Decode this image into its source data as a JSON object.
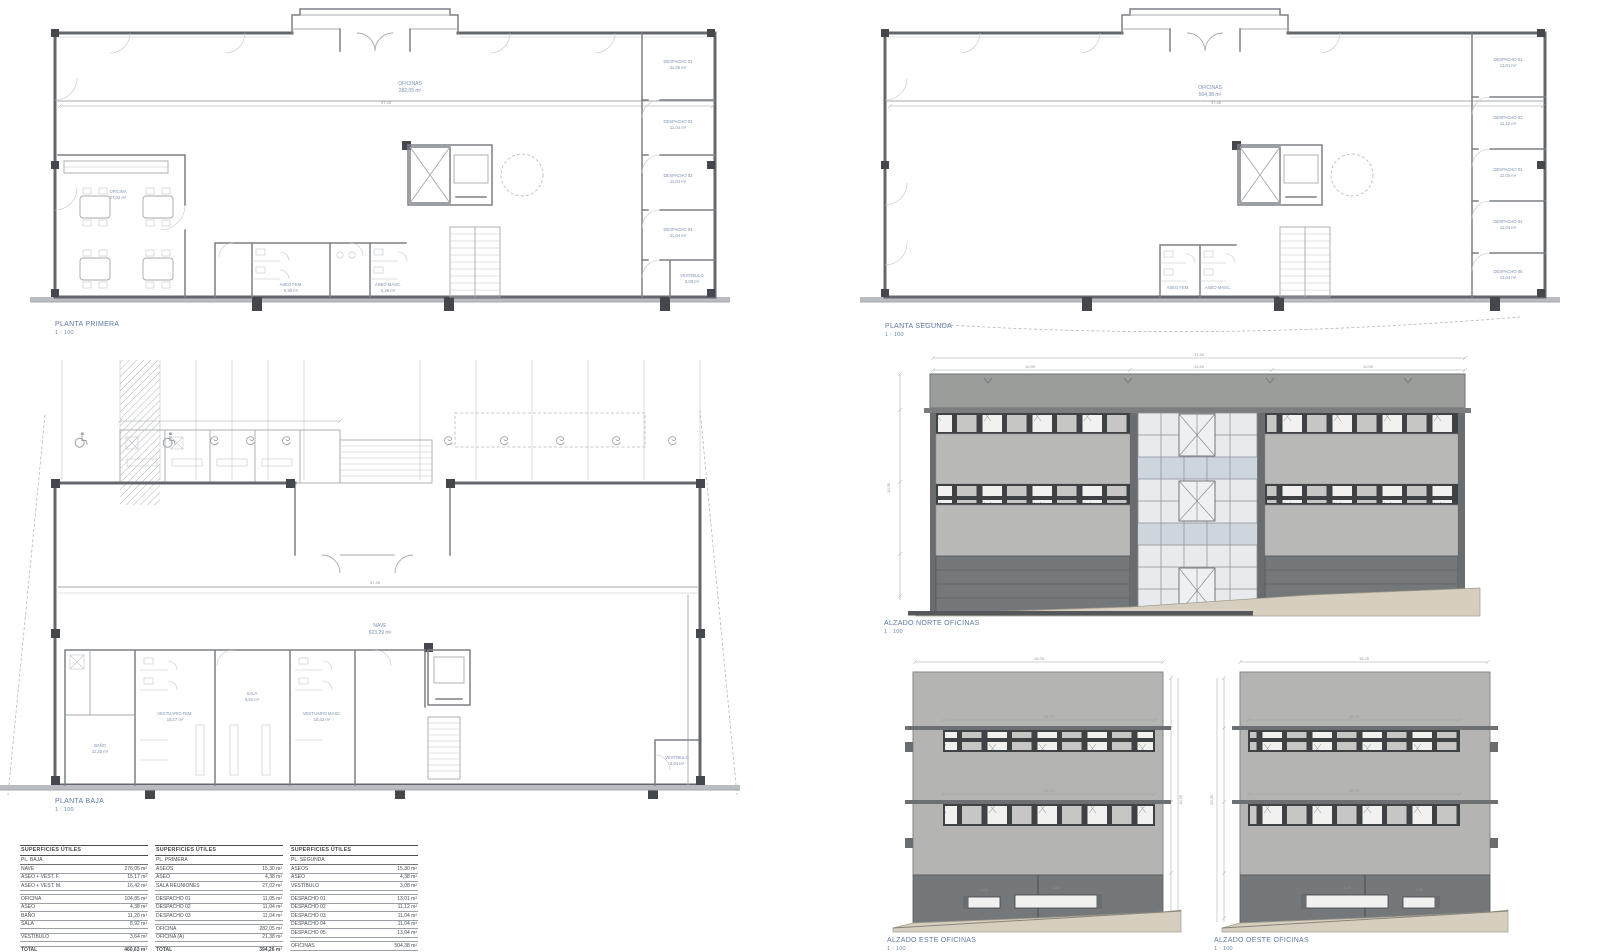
{
  "colors": {
    "label_blue": "#7b90b5",
    "title_blue": "#5d79a8",
    "wall_gray": "#63676c",
    "parapet_gray": "#9b9d9b",
    "spandrel_gray": "#b9bab7",
    "base_gray": "#75787b",
    "terrain_beige": "#d6cfc0",
    "glass_blue": "#ccd6dc"
  },
  "plans": {
    "first": {
      "title": "PLANTA PRIMERA",
      "scale": "1 : 100",
      "dim_overall": "37,45",
      "open_area": {
        "name": "OFICINAS",
        "area": "282,05 m²"
      },
      "meeting_room": {
        "name": "OFICINA",
        "area": "27,02 m²"
      },
      "toilets": [
        {
          "name": "ASEO FEM.",
          "area": "5,30 m²"
        },
        {
          "name": "ASEO MASC.",
          "area": "5,36 m²"
        }
      ],
      "vestibule": {
        "name": "VESTÍBULO",
        "area": "3,08 m²"
      },
      "offices": [
        {
          "name": "DESPACHO 01",
          "area": "11,05 m²"
        },
        {
          "name": "DESPACHO 02",
          "area": "11,04 m²"
        },
        {
          "name": "DESPACHO 03",
          "area": "11,04 m²"
        },
        {
          "name": "DESPACHO 04",
          "area": "11,04 m²"
        }
      ]
    },
    "second": {
      "title": "PLANTA SEGUNDA",
      "scale": "1 : 100",
      "dim_overall": "37,45",
      "open_area": {
        "name": "OFICINAS",
        "area": "504,38 m²"
      },
      "toilets": [
        {
          "name": "ASEO FEM.",
          "area": "5,30 m²"
        },
        {
          "name": "ASEO MASC.",
          "area": "5,36 m²"
        }
      ],
      "offices": [
        {
          "name": "DESPACHO 01",
          "area": "13,01 m²"
        },
        {
          "name": "DESPACHO 02",
          "area": "11,12 m²"
        },
        {
          "name": "DESPACHO 03",
          "area": "11,04 m²"
        },
        {
          "name": "DESPACHO 04",
          "area": "11,04 m²"
        },
        {
          "name": "DESPACHO 05",
          "area": "13,04 m²"
        }
      ]
    },
    "ground": {
      "title": "PLANTA BAJA",
      "scale": "1 : 100",
      "dim_overall": "37,45",
      "open_area": {
        "name": "NAVE",
        "area": "623,29 m²"
      },
      "rooms": [
        {
          "name": "BAÑO",
          "area": "11,20 m²"
        },
        {
          "name": "VESTUARIO FEM.",
          "area": "15,17 m²"
        },
        {
          "name": "SALA",
          "area": "8,92 m²"
        },
        {
          "name": "VESTUARIO MASC.",
          "area": "16,42 m²"
        },
        {
          "name": "VESTÍBULO",
          "area": "3,64 m²"
        }
      ]
    }
  },
  "elevations": {
    "north": {
      "title": "ALZADO NORTE OFICINAS",
      "scale": "1 : 100",
      "dims": {
        "overall": "37,45",
        "left_wing": "10,90",
        "center": "12,40",
        "right_wing": "10,90",
        "height": "10,35"
      }
    },
    "east": {
      "title": "ALZADO ESTE OFICINAS",
      "scale": "1 : 100",
      "dims": {
        "overall": "15,25",
        "strip_top": "12,70",
        "strip_mid": "12,70",
        "slot_small": "1,00",
        "slot_big": "4,20",
        "height": "10,35"
      }
    },
    "west": {
      "title": "ALZADO OESTE OFICINAS",
      "scale": "1 : 100",
      "dims": {
        "overall": "15,25",
        "strip_top": "12,70",
        "strip_mid": "12,70",
        "slot_small": "1,00",
        "slot_big": "4,20",
        "height": "10,35"
      }
    }
  },
  "tables": [
    {
      "header": "SUPERFICIES ÚTILES",
      "subheader": "PL. BAJA",
      "rows": [
        {
          "label": "NAVE",
          "value": "276,05 m²"
        },
        {
          "label": "ASEO + VEST. F.",
          "value": "15,17 m²"
        },
        {
          "label": "ASEO + VEST. M.",
          "value": "16,42 m²"
        },
        {
          "label": "OFICINA",
          "value": "104,85 m²",
          "gap": true
        },
        {
          "label": "ASEO",
          "value": "4,38 m²"
        },
        {
          "label": "BAÑO",
          "value": "11,20 m²"
        },
        {
          "label": "SALA",
          "value": "8,92 m²"
        },
        {
          "label": "VESTÍBULO",
          "value": "3,64 m²",
          "gap": true
        },
        {
          "label": "TOTAL",
          "value": "460,63 m²",
          "gap": true,
          "strong": true
        },
        {
          "label": "TOTAL CONST.",
          "value": "486,20 m²"
        }
      ]
    },
    {
      "header": "SUPERFICIES ÚTILES",
      "subheader": "PL. PRIMERA",
      "rows": [
        {
          "label": "ASEOS",
          "value": "15,30 m²"
        },
        {
          "label": "ASEO",
          "value": "4,38 m²"
        },
        {
          "label": "SALA REUNIONES",
          "value": "27,02 m²"
        },
        {
          "label": "DESPACHO 01",
          "value": "11,05 m²",
          "gap": true
        },
        {
          "label": "DESPACHO 02",
          "value": "11,04 m²"
        },
        {
          "label": "DESPACHO 03",
          "value": "11,04 m²"
        },
        {
          "label": "OFICINA",
          "value": "282,05 m²",
          "gap": true
        },
        {
          "label": "OFICINA (A)",
          "value": "21,38 m²"
        },
        {
          "label": "TOTAL",
          "value": "394,26 m²",
          "gap": true,
          "strong": true
        }
      ]
    },
    {
      "header": "SUPERFICIES ÚTILES",
      "subheader": "PL. SEGUNDA",
      "rows": [
        {
          "label": "ASEOS",
          "value": "15,30 m²"
        },
        {
          "label": "ASEO",
          "value": "4,38 m²"
        },
        {
          "label": "VESTÍBULO",
          "value": "3,08 m²"
        },
        {
          "label": "DESPACHO 01",
          "value": "13,01 m²",
          "gap": true
        },
        {
          "label": "DESPACHO 02",
          "value": "11,12 m²"
        },
        {
          "label": "DESPACHO 03",
          "value": "11,04 m²"
        },
        {
          "label": "DESPACHO 04",
          "value": "11,04 m²"
        },
        {
          "label": "DESPACHO 05",
          "value": "13,04 m²"
        },
        {
          "label": "OFICINAS",
          "value": "504,38 m²",
          "gap": true
        },
        {
          "label": "TOTAL",
          "value": "598,39 m²",
          "gap": true,
          "strong": true
        }
      ]
    }
  ]
}
